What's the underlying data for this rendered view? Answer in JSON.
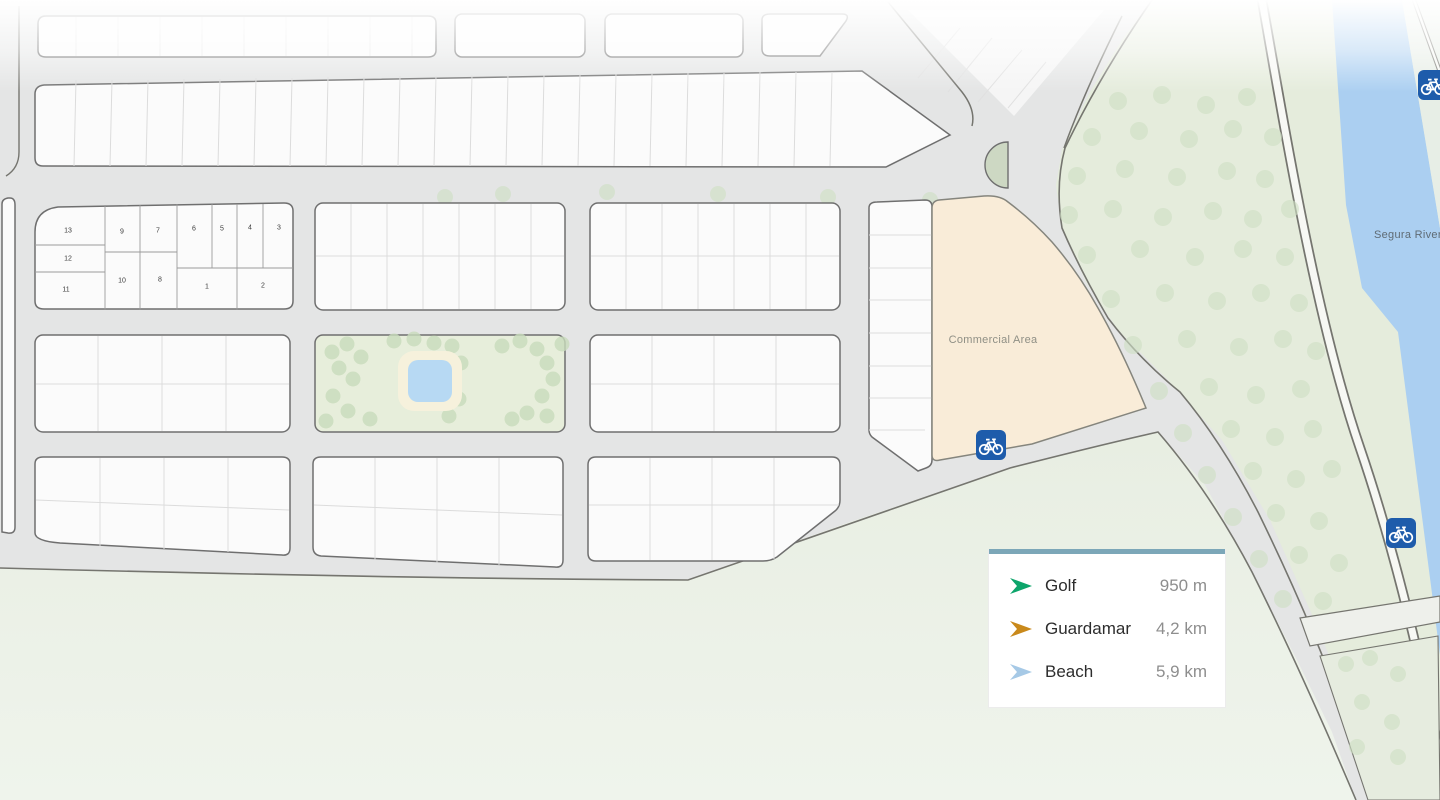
{
  "map": {
    "commercial_area_label": "Commercial Area",
    "river_label": "Segura River",
    "plot_numbers": [
      "13",
      "9",
      "7",
      "6",
      "5",
      "4",
      "3",
      "12",
      "10",
      "8",
      "11",
      "1",
      "2"
    ]
  },
  "legend": {
    "items": [
      {
        "label": "Golf",
        "value": "950 m",
        "arrow_color": "#0da56b"
      },
      {
        "label": "Guardamar",
        "value": "4,2 km",
        "arrow_color": "#c9891b"
      },
      {
        "label": "Beach",
        "value": "5,9 km",
        "arrow_color": "#a6c9e6"
      }
    ]
  },
  "icons": {
    "bike_marker": "bicycle-icon",
    "legend_arrow": "direction-arrow-icon"
  },
  "colors": {
    "road_gray": "#e4e5e5",
    "block_fill": "#fbfbfb",
    "block_outline": "#6f6f6f",
    "bottom_green": "#e9efe4",
    "area_green": "#e5ecdc",
    "park_green": "#e7eedb",
    "tree_green": "#cfe0c4",
    "commercial": "#f9ecd8",
    "river_blue": "#abcff1",
    "pool_blue": "#b7d9f3",
    "bike_blue": "#1e5cab",
    "legend_bar": "#7ca7b8"
  }
}
